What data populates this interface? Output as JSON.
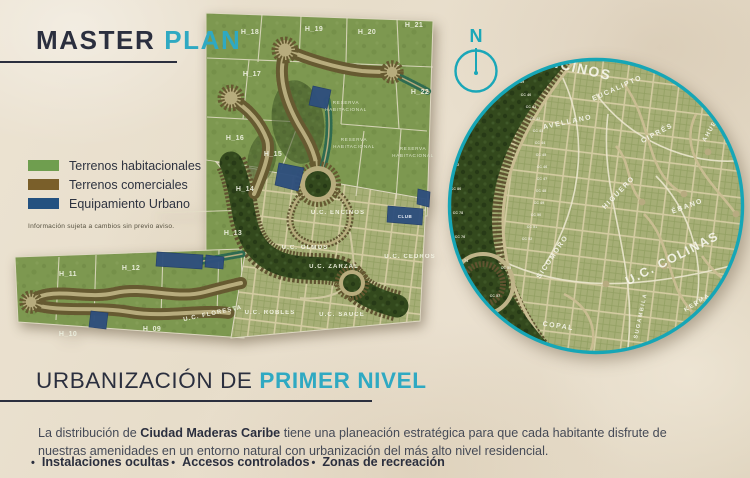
{
  "header": {
    "title_dark": "MASTER ",
    "title_accent": "PLAN"
  },
  "legend": {
    "items": [
      {
        "label": "Terrenos habitacionales",
        "color": "#6f9e4f"
      },
      {
        "label": "Terrenos comerciales",
        "color": "#7a5f2a"
      },
      {
        "label": "Equipamiento Urbano",
        "color": "#235180"
      }
    ],
    "disclaimer": "Información sujeta a cambios sin previo aviso."
  },
  "compass": {
    "label": "N"
  },
  "section": {
    "title_dark": "URBANIZACIÓN DE ",
    "title_accent": "PRIMER NIVEL"
  },
  "body": {
    "intro_prefix": "La distribución de ",
    "intro_bold": "Ciudad Maderas Caribe",
    "intro_suffix": " tiene una planeación estratégica para que cada habitante disfrute de nuestras amenidades en un entorno natural con urbanización del más alto nivel residencial.",
    "bullet": "•",
    "features": [
      {
        "label": "Instalaciones ocultas"
      },
      {
        "label": "Accesos controlados"
      },
      {
        "label": "Zonas de recreación"
      }
    ]
  },
  "colors": {
    "accent_teal": "#2fa9c2",
    "heading_navy": "#2b2f3e",
    "map_green": "#7d9850",
    "forest_green": "#33491d",
    "road_tan": "#b7ac7d",
    "lot_brown": "#665a31",
    "equipamiento_blue": "#2e4f7d",
    "inset_ring_teal": "#16a6b6",
    "sand": "#e8dfce"
  },
  "map": {
    "parcel_labels": [
      {
        "label": "H_18",
        "x": 250,
        "y": 34
      },
      {
        "label": "H_19",
        "x": 314,
        "y": 31
      },
      {
        "label": "H_20",
        "x": 367,
        "y": 34
      },
      {
        "label": "H_21",
        "x": 414,
        "y": 27
      },
      {
        "label": "H_17",
        "x": 252,
        "y": 76
      },
      {
        "label": "H_22",
        "x": 420,
        "y": 94
      },
      {
        "label": "H_16",
        "x": 235,
        "y": 140
      },
      {
        "label": "H_15",
        "x": 273,
        "y": 156
      },
      {
        "label": "H_14",
        "x": 245,
        "y": 191
      },
      {
        "label": "H_13",
        "x": 233,
        "y": 235
      },
      {
        "label": "H_12",
        "x": 131,
        "y": 270
      },
      {
        "label": "H_11",
        "x": 68,
        "y": 276
      },
      {
        "label": "H_10",
        "x": 68,
        "y": 336
      },
      {
        "label": "H_09",
        "x": 152,
        "y": 331
      }
    ],
    "reserve_labels": [
      {
        "label": "RESERVA",
        "x": 346,
        "y": 104
      },
      {
        "label": "HABITACIONAL",
        "x": 346,
        "y": 111
      },
      {
        "label": "RESERVA",
        "x": 354,
        "y": 141
      },
      {
        "label": "HABITACIONAL",
        "x": 354,
        "y": 148
      },
      {
        "label": "RESERVA",
        "x": 413,
        "y": 150
      },
      {
        "label": "HABITACIONAL",
        "x": 413,
        "y": 157
      }
    ],
    "unit_labels": [
      {
        "label": "U.C. ENCINOS",
        "x": 338,
        "y": 214
      },
      {
        "label": "U.C. OLMOS",
        "x": 305,
        "y": 249
      },
      {
        "label": "U.C. ZARZAL",
        "x": 334,
        "y": 268
      },
      {
        "label": "U.C. ROBLES",
        "x": 270,
        "y": 314
      },
      {
        "label": "U.C. SAUCE",
        "x": 342,
        "y": 316
      },
      {
        "label": "U.C. CEDROS",
        "x": 410,
        "y": 258
      },
      {
        "label": "U.C. FLORESTA",
        "x": 213,
        "y": 315,
        "rot": -12
      }
    ],
    "misc_labels": [
      {
        "label": "CLUB",
        "x": 405,
        "y": 218
      }
    ]
  },
  "inset": {
    "street_labels": [
      {
        "label": "ENCINOS",
        "x": 128,
        "y": 16,
        "rot": 13,
        "size": 14
      },
      {
        "label": "EUCALIPTO",
        "x": 172,
        "y": 34,
        "rot": -24,
        "size": 7
      },
      {
        "label": "AHUEHUETE",
        "x": 272,
        "y": 64,
        "rot": -60,
        "size": 6
      },
      {
        "label": "AVELLANO",
        "x": 122,
        "y": 68,
        "rot": -12,
        "size": 7
      },
      {
        "label": "CIPRÉS",
        "x": 212,
        "y": 79,
        "rot": -28,
        "size": 7
      },
      {
        "label": "HIGUERO",
        "x": 174,
        "y": 138,
        "rot": -46,
        "size": 7
      },
      {
        "label": "ÉBANO",
        "x": 242,
        "y": 152,
        "rot": -20,
        "size": 7
      },
      {
        "label": "U.C. COLINAS",
        "x": 228,
        "y": 206,
        "rot": -27,
        "size": 12.5
      },
      {
        "label": "SICOMORO",
        "x": 108,
        "y": 202,
        "rot": -56,
        "size": 7
      },
      {
        "label": "COPAL",
        "x": 112,
        "y": 272,
        "rot": 8,
        "size": 7
      },
      {
        "label": "SUGAMBILA",
        "x": 196,
        "y": 260,
        "rot": -78,
        "size": 5.5
      },
      {
        "label": "KERMA",
        "x": 252,
        "y": 248,
        "rot": -32,
        "size": 6
      }
    ],
    "lot_labels": [
      {
        "label": "CC 39",
        "x": 73,
        "y": 27
      },
      {
        "label": "CC 40",
        "x": 80,
        "y": 40
      },
      {
        "label": "CC 41",
        "x": 85,
        "y": 52
      },
      {
        "label": "CC 42",
        "x": 89,
        "y": 64
      },
      {
        "label": "CC 43",
        "x": 92,
        "y": 76
      },
      {
        "label": "CC 44",
        "x": 94,
        "y": 88
      },
      {
        "label": "CC 45",
        "x": 95,
        "y": 100
      },
      {
        "label": "CC 46",
        "x": 96,
        "y": 112
      },
      {
        "label": "CC 47",
        "x": 96,
        "y": 124
      },
      {
        "label": "CC 48",
        "x": 95,
        "y": 136
      },
      {
        "label": "CC 49",
        "x": 93,
        "y": 148
      },
      {
        "label": "CC 50",
        "x": 90,
        "y": 160
      },
      {
        "label": "CC 51",
        "x": 86,
        "y": 172
      },
      {
        "label": "CC 52",
        "x": 81,
        "y": 184
      },
      {
        "label": "CC 84",
        "x": 6,
        "y": 86
      },
      {
        "label": "CC 82",
        "x": 8,
        "y": 110
      },
      {
        "label": "CC 80",
        "x": 10,
        "y": 134
      },
      {
        "label": "CC 78",
        "x": 12,
        "y": 158
      },
      {
        "label": "CC 76",
        "x": 14,
        "y": 182
      },
      {
        "label": "CC 74",
        "x": 17,
        "y": 206
      },
      {
        "label": "CC 55",
        "x": 60,
        "y": 213
      },
      {
        "label": "CC 57",
        "x": 49,
        "y": 241
      }
    ]
  }
}
